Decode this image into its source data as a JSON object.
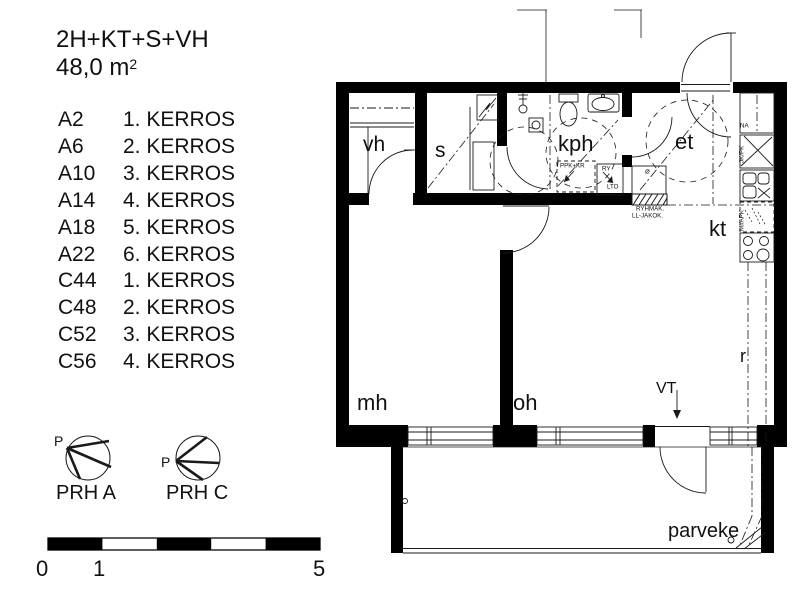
{
  "title": {
    "type_code": "2H+KT+S+VH",
    "area_value": "48,0 m",
    "area_sup": "2"
  },
  "apartments": [
    {
      "code": "A2",
      "floor": "1. KERROS"
    },
    {
      "code": "A6",
      "floor": "2. KERROS"
    },
    {
      "code": "A10",
      "floor": "3. KERROS"
    },
    {
      "code": "A14",
      "floor": "4. KERROS"
    },
    {
      "code": "A18",
      "floor": "5. KERROS"
    },
    {
      "code": "A22",
      "floor": "6. KERROS"
    },
    {
      "code": "C44",
      "floor": "1. KERROS"
    },
    {
      "code": "C48",
      "floor": "2. KERROS"
    },
    {
      "code": "C52",
      "floor": "3. KERROS"
    },
    {
      "code": "C56",
      "floor": "4. KERROS"
    }
  ],
  "rooms": {
    "vh": "vh",
    "s": "s",
    "kph": "kph",
    "et": "et",
    "kt": "kt",
    "mh": "mh",
    "oh": "oh",
    "r": "r",
    "parveke": "parveke"
  },
  "annotations": {
    "vt": "VT",
    "ppk_kr": "PPK+KR",
    "ry": "RY",
    "lto": "LTO",
    "ryhmak": "RYHMÄK.",
    "ll_jakok": "LL-JAKOK.",
    "na": "NA",
    "jk_pk": "JK/PK",
    "mi_apk": "MI/APK",
    "panel_symbol": "⌀"
  },
  "compass": {
    "north": "P",
    "a_label": "PRH A",
    "c_label": "PRH C"
  },
  "scale_bar": {
    "start": "0",
    "mid": "1",
    "end": "5"
  },
  "colors": {
    "wall": "#000000",
    "line": "#1a1a1a",
    "background": "#ffffff"
  }
}
